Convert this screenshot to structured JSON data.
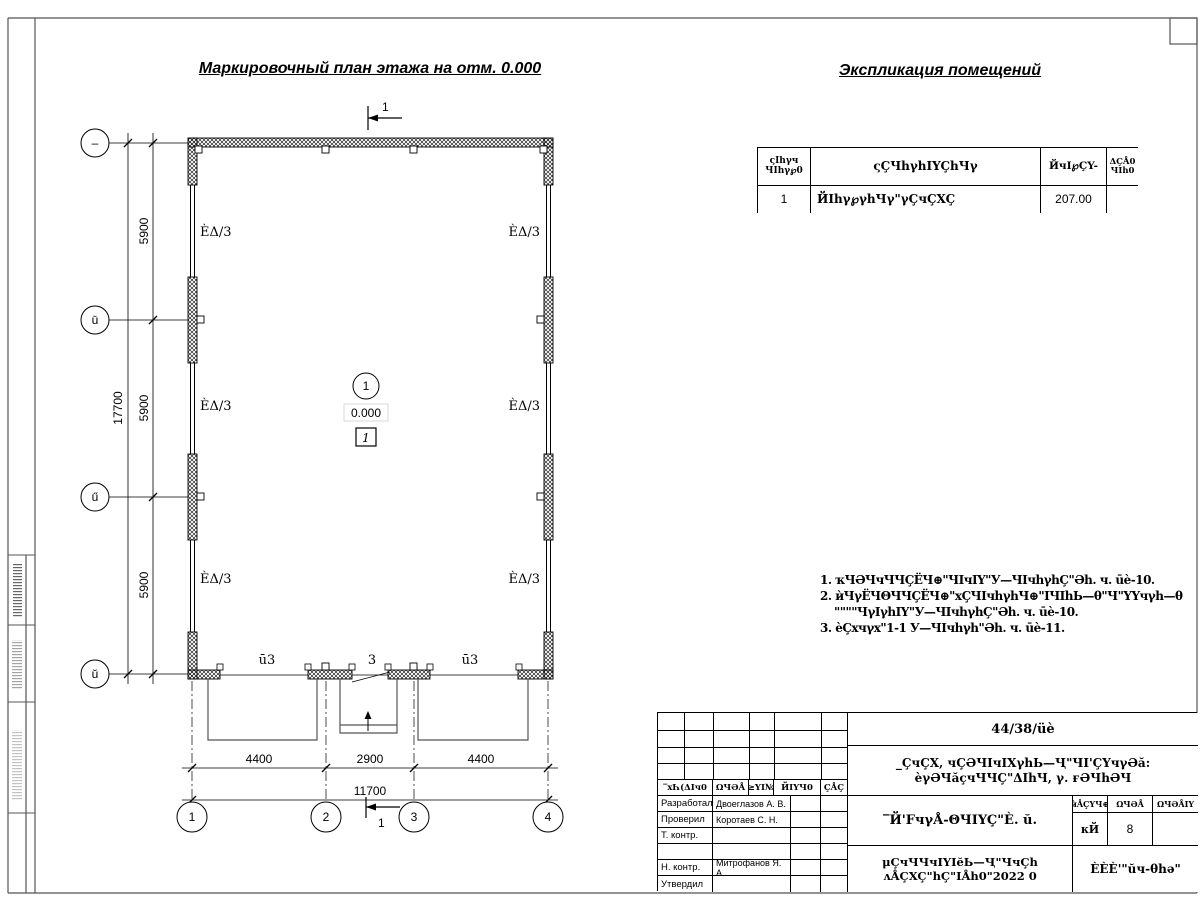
{
  "titles": {
    "plan": "Маркировочный план этажа на отм. 0.000",
    "explication": "Экспликация помещений"
  },
  "plan": {
    "section_label": "1",
    "room": {
      "number": "1",
      "elevation": "0.000",
      "category": "1"
    },
    "labels": {
      "panel": "ÈΔ/3",
      "door_side": "ū3",
      "door_center": "3"
    },
    "dims_left": [
      "5900",
      "5900",
      "5900"
    ],
    "dim_left_total": "17700",
    "dims_bottom": [
      "4400",
      "2900",
      "4400"
    ],
    "dim_bottom_total": "11700",
    "axes_left": [
      "–",
      "ū",
      "ű",
      "ŭ"
    ],
    "axes_bottom": [
      "1",
      "2",
      "3",
      "4"
    ]
  },
  "explication": {
    "headers": {
      "num1": "ςIhγч",
      "num2": "ЧIhγ℘0",
      "name": "ςÇЧhγhIYÇhЧγ",
      "area": "ЙчI℘ÇY-",
      "note1": "ΔÇÅ0",
      "note2": "ЧIh0"
    },
    "row": {
      "num": "1",
      "name": "ЙIhγ℘γhЧγ\"γÇчÇXÇ",
      "area": "207.00",
      "note": ""
    }
  },
  "notes": {
    "lines": [
      "1. ҡЧӘЧчЧЧÇЁЧ⊕\"ЧIчIY\"У—ЧIчhγhÇ\"Әh. ч. ūè-10.",
      "2. ѝЧγЁЧΘЧЧÇЁЧ⊕\"xÇЧIчhγhЧ⊕\"IЧIhЬ—θ\"Ч\"YYчγh—θ",
      "\"\"\"\"ЧγIγhIY\"У—ЧIчhγhÇ\"Әh. ч. ūè-10.",
      "3. ѐÇxчγx\"1-1 У—ЧIчhγh\"Әh. ч. ūè-11."
    ]
  },
  "title_block": {
    "doc_number": "44/38/üè",
    "project_line1": "_ÇчÇX, чÇӘЧIчIXγhЬ—Ҷ\"ЧI'ÇYчγӘӑ:",
    "project_line2": "ѐγӘЧӑçчЧЧÇ\"ΔIhЧ, γ. ғӘЧhӘЧ",
    "object": "‾Й'FчγÅ-ΘЧIYÇ\"È. ŭ.",
    "doc_line1": "μÇчЧЧчIYIĕЬ—Ҷ\"ЧчÇh",
    "doc_line2": "ʌÅÇXÇ\"hÇ\"IÅh0\"2022 0",
    "company": "ÈÈÈ'\"ŭч-θhә\"",
    "header_cells": [
      "‾xҺ(ΔIч0",
      "ΩЧӘÅ",
      "≥YI№",
      "ЙIYЧ0",
      "ÇÅÇ"
    ],
    "stage": {
      "h1": "ѝÅÇYЧ⊕",
      "h2": "ΩЧӘÅ",
      "h3": "ΩЧӘÅIY",
      "v1": "кЙ",
      "v2": "8",
      "v3": ""
    },
    "roles": [
      {
        "label": "Разработал",
        "name": "Двоеглазов А. В."
      },
      {
        "label": "Проверил",
        "name": "Коротаев С. Н."
      },
      {
        "label": "Т. контр.",
        "name": ""
      },
      {
        "label": "",
        "name": ""
      },
      {
        "label": "Н. контр.",
        "name": "Митрофанов Я. А."
      },
      {
        "label": "Утвердил",
        "name": ""
      }
    ]
  }
}
